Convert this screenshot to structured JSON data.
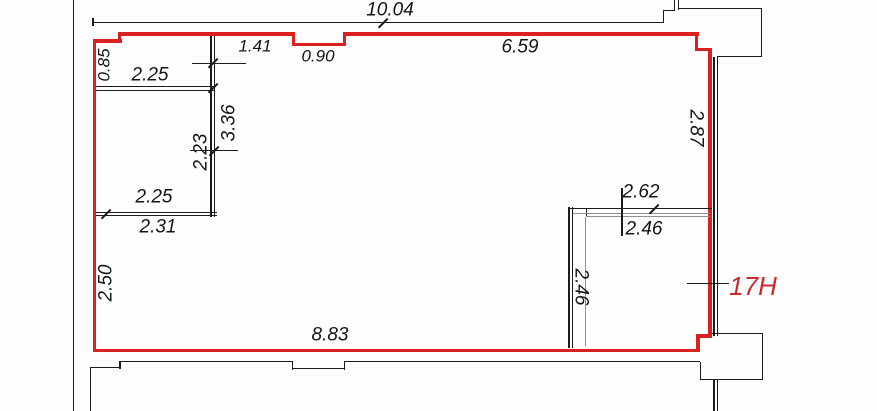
{
  "plan": {
    "type": "floor-plan",
    "unit": {
      "label": "17H",
      "label_color": "#cc2a2a"
    },
    "colors": {
      "unit_boundary": "#d92121",
      "structure_wall": "#1c1c1c",
      "light_wall": "#8f8f8f",
      "dimension_text": "#151515"
    },
    "dims": {
      "top_total": "10.04",
      "top_141": "1.41",
      "top_090": "0.90",
      "top_659": "6.59",
      "left_085": "0.85",
      "rooma_225": "2.25",
      "wall_336": "3.36",
      "roomb_223": "2.23",
      "right_287": "2.87",
      "roomb_225": "2.25",
      "roomb_231": "2.31",
      "left_250": "2.50",
      "roomc_262": "2.62",
      "roomc_246_top": "2.46",
      "roomc_246_side": "2.46",
      "bottom_883": "8.83"
    }
  }
}
